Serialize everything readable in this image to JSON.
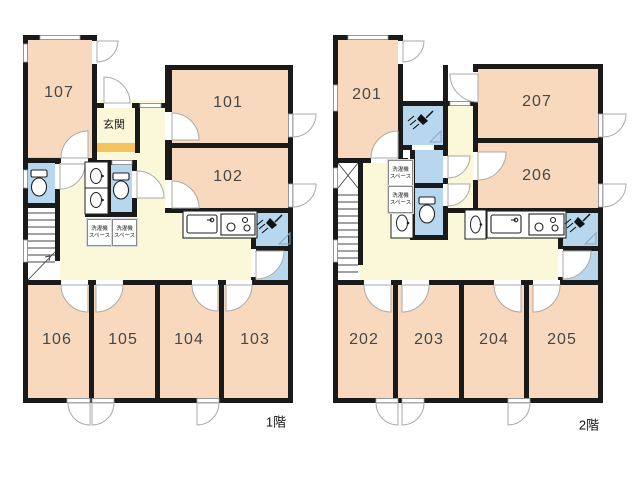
{
  "colors": {
    "room_fill": "#F9D9BD",
    "hall_fill": "#FAF8D8",
    "wet_area_fill": "#B6D7EE",
    "entrance_step_fill": "#F5C45E",
    "wall": "#1A1A1A",
    "door_arc_stroke": "#AAAAAA"
  },
  "labels": {
    "entrance": "玄関",
    "laundry_line1": "洗濯機",
    "laundry_line2": "スペース"
  },
  "floor1": {
    "floor_label": "1階",
    "rooms": {
      "r101": "101",
      "r102": "102",
      "r103": "103",
      "r104": "104",
      "r105": "105",
      "r106": "106",
      "r107": "107"
    }
  },
  "floor2": {
    "floor_label": "2階",
    "rooms": {
      "r201": "201",
      "r202": "202",
      "r203": "203",
      "r204": "204",
      "r205": "205",
      "r206": "206",
      "r207": "207"
    }
  }
}
